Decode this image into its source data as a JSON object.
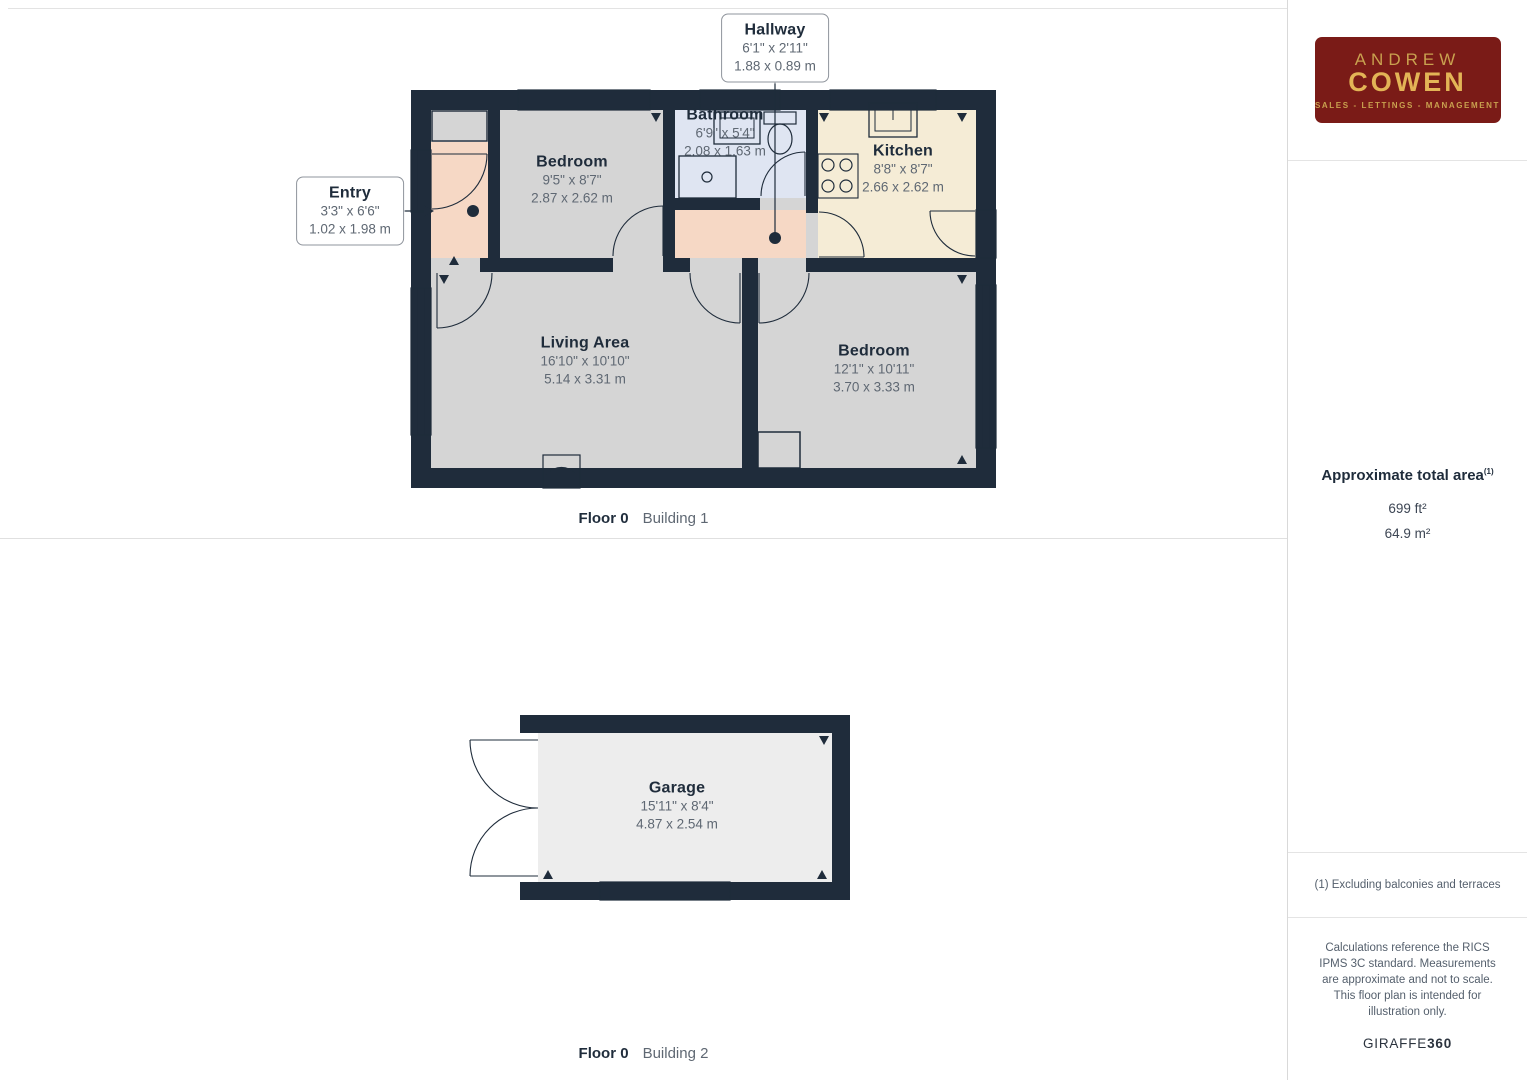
{
  "colors": {
    "wall": "#1f2c3b",
    "room": "#d5d5d5",
    "accent_peach": "#f6d8c5",
    "kitchen_cream": "#f5ecd6",
    "bathroom_blue": "#dfe5f2",
    "garage_floor": "#ededed",
    "logo_bg": "#7a1b17",
    "logo_gold": "#e3b456",
    "logo_gold_light": "#c9a14f",
    "label_dark": "#1f2c3b",
    "label_gray": "#5f6873"
  },
  "plans": [
    {
      "caption": {
        "floor": "Floor 0",
        "building": "Building 1"
      },
      "rooms": [
        {
          "id": "hallway",
          "name": "Hallway",
          "imperial": "6'1\" x 2'11\"",
          "metric": "1.88 x 0.89 m"
        },
        {
          "id": "entry",
          "name": "Entry",
          "imperial": "3'3\" x 6'6\"",
          "metric": "1.02 x 1.98 m"
        },
        {
          "id": "bedroom-1",
          "name": "Bedroom",
          "imperial": "9'5\" x 8'7\"",
          "metric": "2.87 x 2.62 m"
        },
        {
          "id": "bathroom",
          "name": "Bathroom",
          "imperial": "6'9\" x 5'4\"",
          "metric": "2.08 x 1.63 m"
        },
        {
          "id": "kitchen",
          "name": "Kitchen",
          "imperial": "8'8\" x 8'7\"",
          "metric": "2.66 x 2.62 m"
        },
        {
          "id": "living-area",
          "name": "Living Area",
          "imperial": "16'10\" x 10'10\"",
          "metric": "5.14 x 3.31 m"
        },
        {
          "id": "bedroom-2",
          "name": "Bedroom",
          "imperial": "12'1\" x 10'11\"",
          "metric": "3.70 x 3.33 m"
        }
      ]
    },
    {
      "caption": {
        "floor": "Floor 0",
        "building": "Building 2"
      },
      "rooms": [
        {
          "id": "garage",
          "name": "Garage",
          "imperial": "15'11\" x 8'4\"",
          "metric": "4.87 x 2.54 m"
        }
      ]
    }
  ],
  "sidebar": {
    "logo": {
      "line1": "ANDREW",
      "line2": "COWEN",
      "tagline": "SALES - LETTINGS - MANAGEMENT"
    },
    "total_area": {
      "title": "Approximate total area",
      "footnote_ref": "(1)",
      "imperial": "699 ft²",
      "metric": "64.9 m²"
    },
    "footnote": "(1) Excluding balconies and terraces",
    "disclaimer": "Calculations reference the RICS IPMS 3C standard. Measurements are approximate and not to scale. This floor plan is intended for illustration only.",
    "brand": {
      "name": "GIRAFFE",
      "suffix": "360"
    }
  }
}
